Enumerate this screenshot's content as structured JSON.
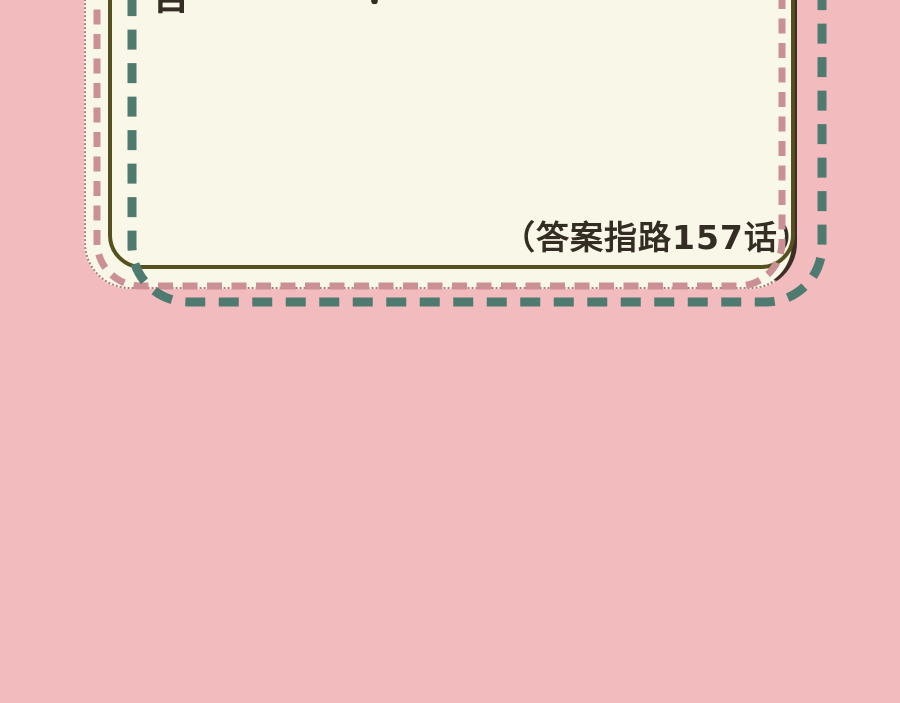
{
  "colors": {
    "bg_pink": "#f2bcbe",
    "cream": "#f9f7e7",
    "olive": "#55511e",
    "teal": "#4e7a70",
    "dusty_pink": "#cb9096",
    "dotted_edge": "#b08078",
    "dark_edge": "#3e2e27",
    "ink": "#332d24"
  },
  "note_card": {
    "answer_note": "（答案指路157话）",
    "cutoff_fragment_main": "答",
    "cutoff_fragment_exclaim": "！"
  }
}
